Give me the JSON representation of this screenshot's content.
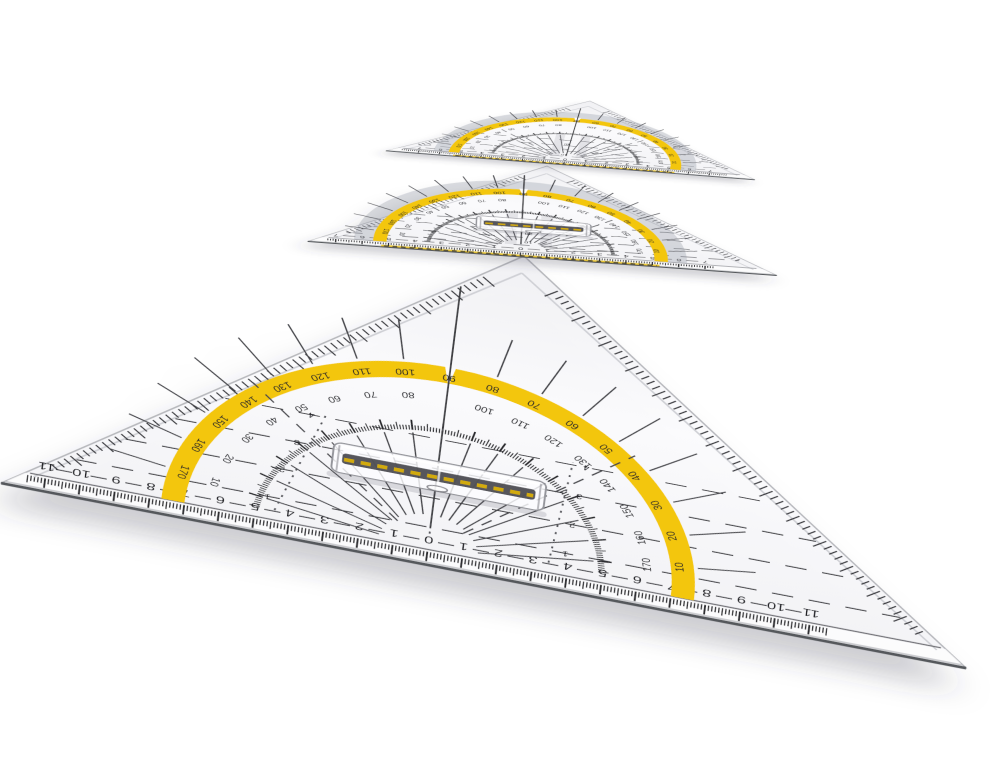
{
  "colors": {
    "band_yellow": "#f3c608",
    "ink": "#232428",
    "plastic_edge": "#b6b7bc",
    "edge_dark": "#55585c",
    "gray_ring": "#9094a0",
    "background": "#ffffff"
  },
  "triangles": [
    {
      "name": "large-set-square",
      "degrees_on_band": [
        "170",
        "160",
        "150",
        "140",
        "130",
        "120",
        "110",
        "100",
        "90",
        "80",
        "70",
        "60",
        "50",
        "40",
        "30",
        "20",
        "10"
      ],
      "degrees_inner": [
        "10",
        "20",
        "30",
        "40",
        "50",
        "60",
        "70",
        "80",
        "90",
        "100",
        "110",
        "120",
        "130",
        "140",
        "150",
        "160",
        "170"
      ],
      "hypotenuse_scale": [
        "11",
        "10",
        "9",
        "8",
        "7",
        "6",
        "5",
        "4",
        "3",
        "2",
        "1",
        "0",
        "1",
        "2",
        "3",
        "4",
        "5",
        "6",
        "7",
        "8",
        "9",
        "10",
        "11"
      ],
      "parallel_labels": [
        "1",
        "2",
        "3",
        "4"
      ]
    },
    {
      "name": "medium-set-square",
      "degrees_on_band": [
        "170",
        "160",
        "150",
        "140",
        "130",
        "120",
        "110",
        "100",
        "90",
        "80",
        "70",
        "60",
        "50",
        "40",
        "30",
        "20",
        "10"
      ],
      "degrees_inner": [
        "10",
        "20",
        "30",
        "40",
        "50",
        "60",
        "70",
        "80",
        "90",
        "100",
        "110",
        "120",
        "130",
        "140",
        "150",
        "160",
        "170"
      ],
      "hypotenuse_scale": [
        "7",
        "6",
        "5",
        "4",
        "3",
        "2",
        "1",
        "0",
        "1",
        "2",
        "3",
        "4",
        "5",
        "6",
        "7"
      ],
      "height_labels": [
        "10",
        "20",
        "30"
      ]
    },
    {
      "name": "small-set-square",
      "degrees_on_band": [
        "170",
        "160",
        "150",
        "140",
        "130",
        "120",
        "110",
        "100",
        "90",
        "80",
        "70",
        "60",
        "50",
        "40",
        "30",
        "20",
        "10"
      ],
      "degrees_inner": [
        "10",
        "20",
        "30",
        "40",
        "50",
        "60",
        "70",
        "80",
        "90",
        "100",
        "110",
        "120",
        "130",
        "140",
        "150",
        "160",
        "170"
      ],
      "hypotenuse_scale": [
        "7",
        "6",
        "5",
        "4",
        "3",
        "2",
        "1",
        "0",
        "1",
        "2",
        "3",
        "4",
        "5",
        "6",
        "7"
      ],
      "height_labels": [
        "10",
        "20",
        "30"
      ]
    }
  ]
}
